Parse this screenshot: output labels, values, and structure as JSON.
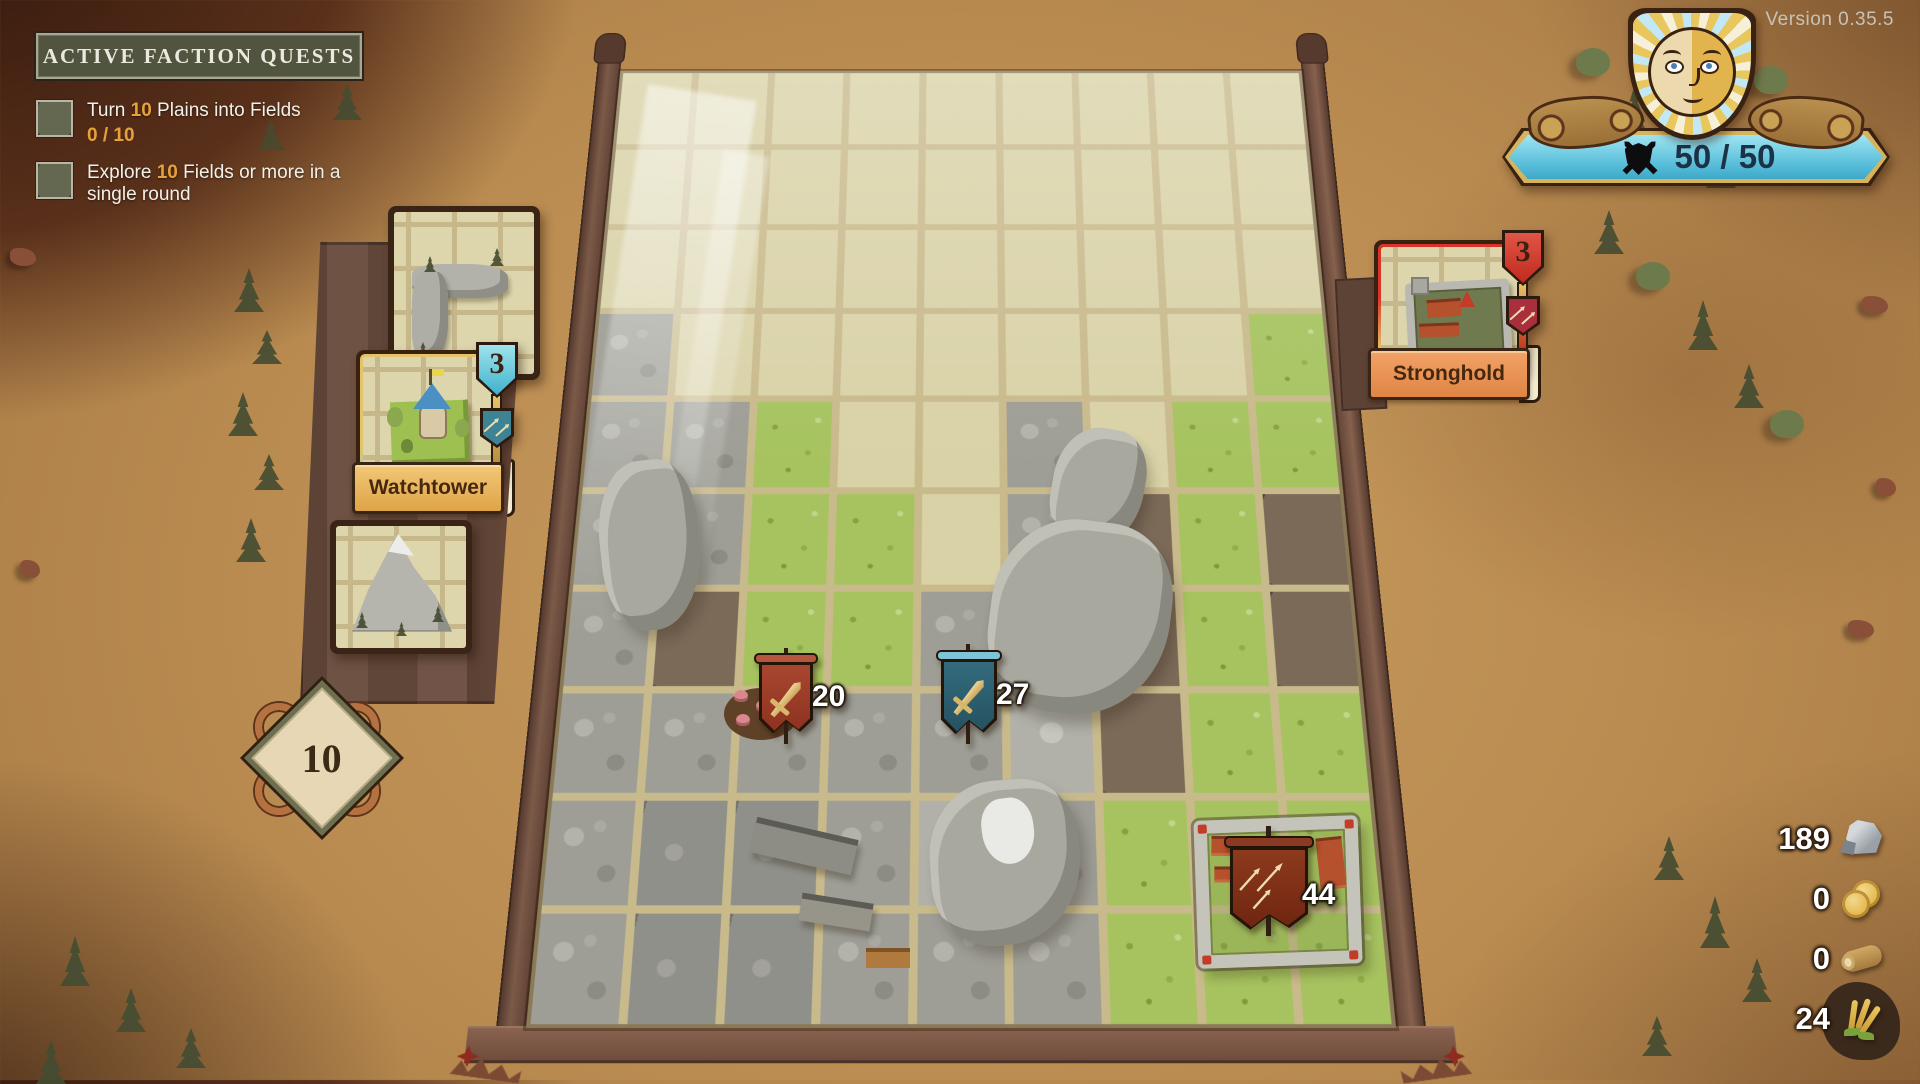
{
  "version_label": "Version 0.35.5",
  "quests": {
    "title": "ACTIVE FACTION QUESTS",
    "items": [
      {
        "text_prefix": "Turn ",
        "amount": "10",
        "text_suffix": " Plains into Fields",
        "progress": "0 / 10"
      },
      {
        "text_prefix": "Explore ",
        "amount": "10",
        "text_suffix": " Fields or more in a single round",
        "progress": ""
      }
    ]
  },
  "hud": {
    "hp_value": "50 / 50",
    "hp_icon": "shield-crossed-swords-icon",
    "banner_color": "#55bcd8",
    "emblem": "sun-face-shield"
  },
  "hand": {
    "deck_count": "10",
    "cards": [
      {
        "name": "",
        "type": "corner-rocks-tile"
      },
      {
        "name": "Watchtower",
        "count": "3",
        "accent": "#49b8d8"
      },
      {
        "name": "",
        "type": "mountain-tile"
      }
    ]
  },
  "enemy_card": {
    "name": "Stronghold",
    "count": "3",
    "accent": "#d8352a"
  },
  "board": {
    "rows": 10,
    "cols": 9,
    "legend": {
      "e": "empty-plains",
      "g": "grass",
      "r": "rocks",
      "b": "dirt",
      "m": "mountain",
      "v": "village",
      "f": "fort-grass"
    },
    "tiles": [
      "eeeeeeeee",
      "eeeeeeeee",
      "eeeeeeeee",
      "reeeeeeeg",
      "rrgeeregg",
      "rrggerbgb",
      "rbggrrbgb",
      "rrrrrmbgg",
      "rvvrmrgfg",
      "rvvrrrggg"
    ],
    "units": [
      {
        "value": "20",
        "banner_color": "#9c3b27",
        "icon": "sword-icon"
      },
      {
        "value": "27",
        "banner_color": "#2a5d6e",
        "icon": "sword-icon"
      },
      {
        "value": "44",
        "banner_color": "#7e2d15",
        "icon": "arrows-icon"
      }
    ]
  },
  "resources": {
    "items": [
      {
        "name": "stone",
        "value": "189"
      },
      {
        "name": "gold",
        "value": "0"
      },
      {
        "name": "wood",
        "value": "0"
      },
      {
        "name": "wheat",
        "value": "24"
      }
    ]
  }
}
